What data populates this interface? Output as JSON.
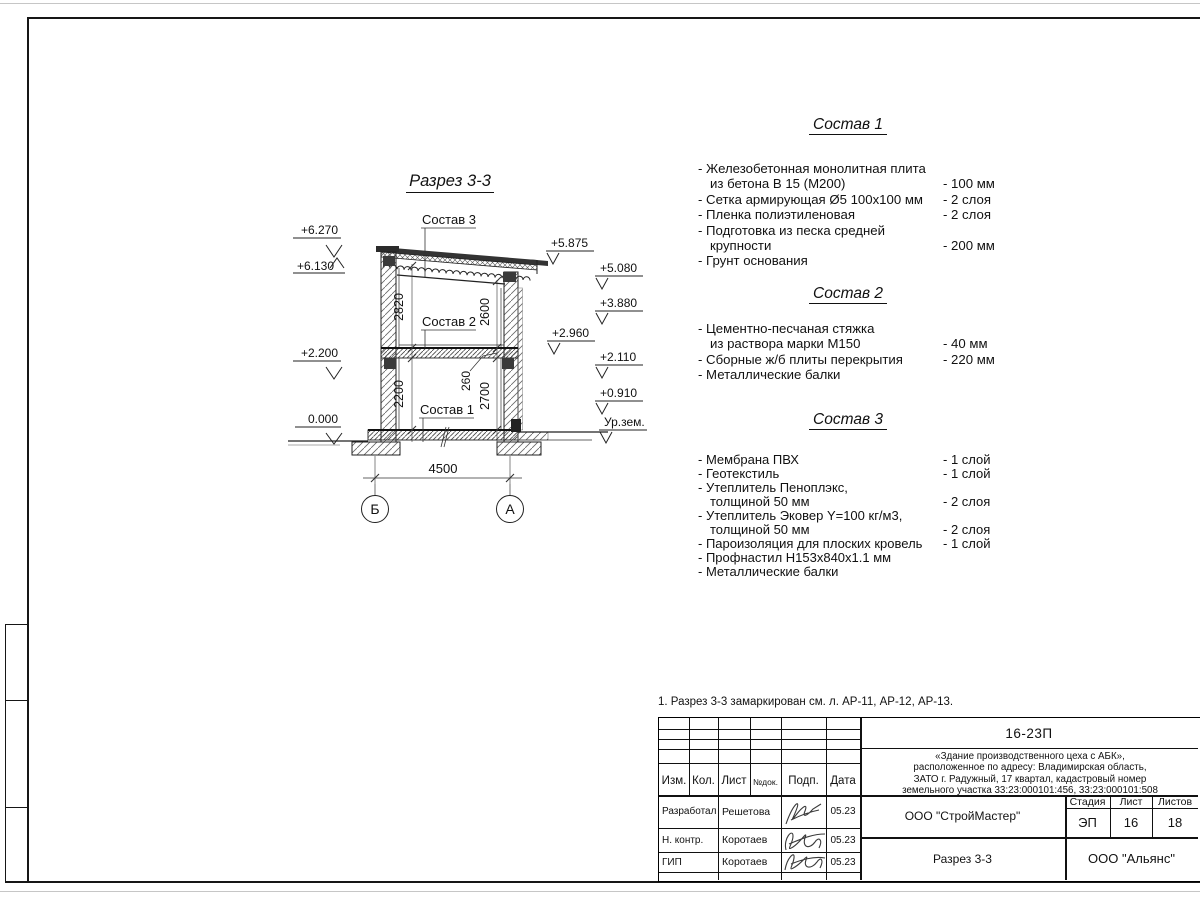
{
  "sheet": {
    "note": "1. Разрез 3-3 замаркирован см. л. АР-11, АР-12, АР-13."
  },
  "drawing": {
    "title": "Разрез 3-3",
    "section_labels": {
      "s1": "Состав 1",
      "s2": "Состав 2",
      "s3": "Состав 3"
    },
    "elevations_left": [
      {
        "value": "+6.270"
      },
      {
        "value": "+6.130"
      },
      {
        "value": "+2.200"
      },
      {
        "value": "0.000"
      }
    ],
    "elevations_right": [
      {
        "value": "+5.875"
      },
      {
        "value": "+5.080"
      },
      {
        "value": "+3.880"
      },
      {
        "value": "+2.960"
      },
      {
        "value": "+2.110"
      },
      {
        "value": "+0.910"
      },
      {
        "value": "Ур.зем."
      }
    ],
    "dims": {
      "h_upper_left": "2820",
      "h_upper_right": "2600",
      "h_lower_left": "2200",
      "floor_pkg": "260",
      "h_lower_right": "2700",
      "span": "4500"
    },
    "axes": {
      "left": "Б",
      "right": "А"
    }
  },
  "compositions": [
    {
      "title": "Состав 1",
      "rows": [
        {
          "t": "- Железобетонная  монолитная плита",
          "v": ""
        },
        {
          "t": "из бетона В 15 (М200)",
          "v": "- 100 мм"
        },
        {
          "t": "- Сетка армирующая Ø5 100х100 мм",
          "v": "- 2 слоя"
        },
        {
          "t": "- Пленка полиэтиленовая",
          "v": "- 2 слоя"
        },
        {
          "t": "- Подготовка из песка средней",
          "v": ""
        },
        {
          "t": "крупности",
          "v": "- 200 мм"
        },
        {
          "t": "- Грунт основания",
          "v": ""
        }
      ]
    },
    {
      "title": "Состав 2",
      "rows": [
        {
          "t": "- Цементно-песчаная стяжка",
          "v": ""
        },
        {
          "t": "из раствора марки М150",
          "v": "- 40 мм"
        },
        {
          "t": "- Сборные ж/б плиты перекрытия",
          "v": "- 220 мм"
        },
        {
          "t": "- Металлические балки",
          "v": ""
        }
      ]
    },
    {
      "title": "Состав 3",
      "rows": [
        {
          "t": "- Мембрана ПВХ",
          "v": "- 1 слой"
        },
        {
          "t": "- Геотекстиль",
          "v": "- 1 слой"
        },
        {
          "t": "- Утеплитель Пеноплэкс,",
          "v": ""
        },
        {
          "t": "толщиной 50 мм",
          "v": "- 2 слоя"
        },
        {
          "t": "- Утеплитель Эковер Y=100 кг/м3,",
          "v": ""
        },
        {
          "t": "толщиной 50 мм",
          "v": "- 2 слоя"
        },
        {
          "t": "- Пароизоляция для плоских кровель",
          "v": "- 1 слой"
        },
        {
          "t": "- Профнастил Н153х840х1.1 мм",
          "v": ""
        },
        {
          "t": "- Металлические балки",
          "v": ""
        }
      ]
    }
  ],
  "title_block": {
    "doc_number": "16-23П",
    "project_lines": [
      "«Здание производственного цеха с АБК»,",
      "расположенное по адресу: Владимирская область,",
      "ЗАТО г. Радужный, 17 квартал, кадастровый номер",
      "земельного участка 33:23:000101:456, 33:23:000101:508"
    ],
    "headers": {
      "izm": "Изм.",
      "kol": "Кол.",
      "list": "Лист",
      "ndok": "№док.",
      "podp": "Подп.",
      "data": "Дата"
    },
    "sign_rows": [
      {
        "role": "Разработал",
        "name": "Решетова",
        "date": "05.23"
      },
      {
        "role": "Н. контр.",
        "name": "Коротаев",
        "date": "05.23"
      },
      {
        "role": "ГИП",
        "name": "Коротаев",
        "date": "05.23"
      }
    ],
    "contractor": "ООО \"СтройМастер\"",
    "stage_header": "Стадия",
    "stage": "ЭП",
    "sheet_header": "Лист",
    "sheet_no": "16",
    "sheets_header": "Листов",
    "sheets_total": "18",
    "sheet_title": "Разрез 3-3",
    "company": "ООО \"Альянс\""
  }
}
